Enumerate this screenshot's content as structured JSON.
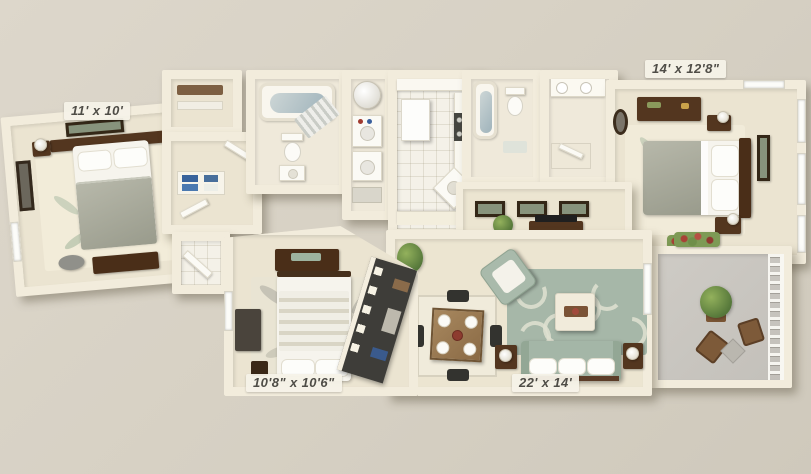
{
  "title": "3D apartment floor plan",
  "rooms": {
    "bedroom_top_left": {
      "name": "bedroom",
      "label": "11' x 10'"
    },
    "bedroom_top_right": {
      "name": "bedroom",
      "label": "14' x 12'8\""
    },
    "bedroom_bottom": {
      "name": "bedroom",
      "label": "10'8\" x 10'6\""
    },
    "living_room": {
      "name": "living room",
      "label": "22' x 14'"
    }
  },
  "colors": {
    "background": "#d8d2c6",
    "walls": "#f2ecdc",
    "carpet": "#ebe4d1",
    "tile": "#f4f1e8",
    "sofa_sage": "#a4b6a7",
    "rug_sage": "#a6b7a8",
    "dark_wood": "#53361f",
    "balcony_floor": "#c9c6c0",
    "label_text": "#4f4d47"
  }
}
